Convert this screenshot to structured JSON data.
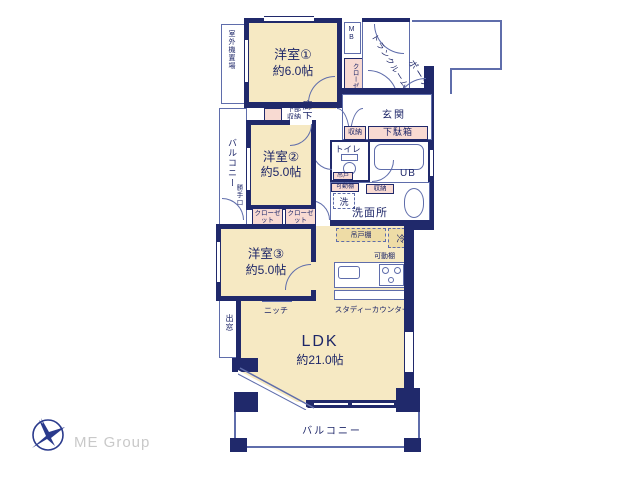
{
  "plan": {
    "rooms": {
      "western1": {
        "name": "洋室①",
        "size": "約6.0帖"
      },
      "western2": {
        "name": "洋室②",
        "size": "約5.0帖"
      },
      "western3": {
        "name": "洋室③",
        "size": "約5.0帖"
      },
      "ldk": {
        "name": "LDK",
        "size": "約21.0帖"
      },
      "entrance": "玄関",
      "hallway": "廊下",
      "toilet": "トイレ",
      "unit_bath": "UB",
      "washroom": "洗面所",
      "porch": "ポーチ",
      "trunk_room": "トランクルーム",
      "meter_box": "MB"
    },
    "outdoor": {
      "balcony_left": "バルコニー",
      "balcony_bottom": "バルコニー",
      "outdoor_unit_space": "室外機置場",
      "bay_window": "出窓",
      "kitchen_door": "勝手口"
    },
    "storage": {
      "closet1": "クローゼット",
      "closet2": "クローゼット",
      "closet3": "クローゼット",
      "shoe_box": "下駄箱",
      "storage_entrance": "収納",
      "storage_wash": "収納",
      "lower_storage": "下部収納",
      "hanging_door": "吊戸",
      "hanging_cupboard": "吊戸棚",
      "movable_shelf_wash": "可動棚",
      "movable_shelf_kitchen": "可動棚"
    },
    "fixtures": {
      "washer": "洗",
      "fridge": "冷",
      "niche": "ニッチ",
      "study_counter": "スタディーカウンター"
    }
  },
  "footer": {
    "logo_text": "ME Group"
  },
  "colors": {
    "wall": "#20296b",
    "room_fill": "#f6e9c3",
    "closet_fill": "#f8dad2",
    "shelf_fill": "#eedca6",
    "line": "#5f6dab",
    "logo_blue": "#2a3a8c",
    "logo_gray": "#c9c9c9"
  }
}
